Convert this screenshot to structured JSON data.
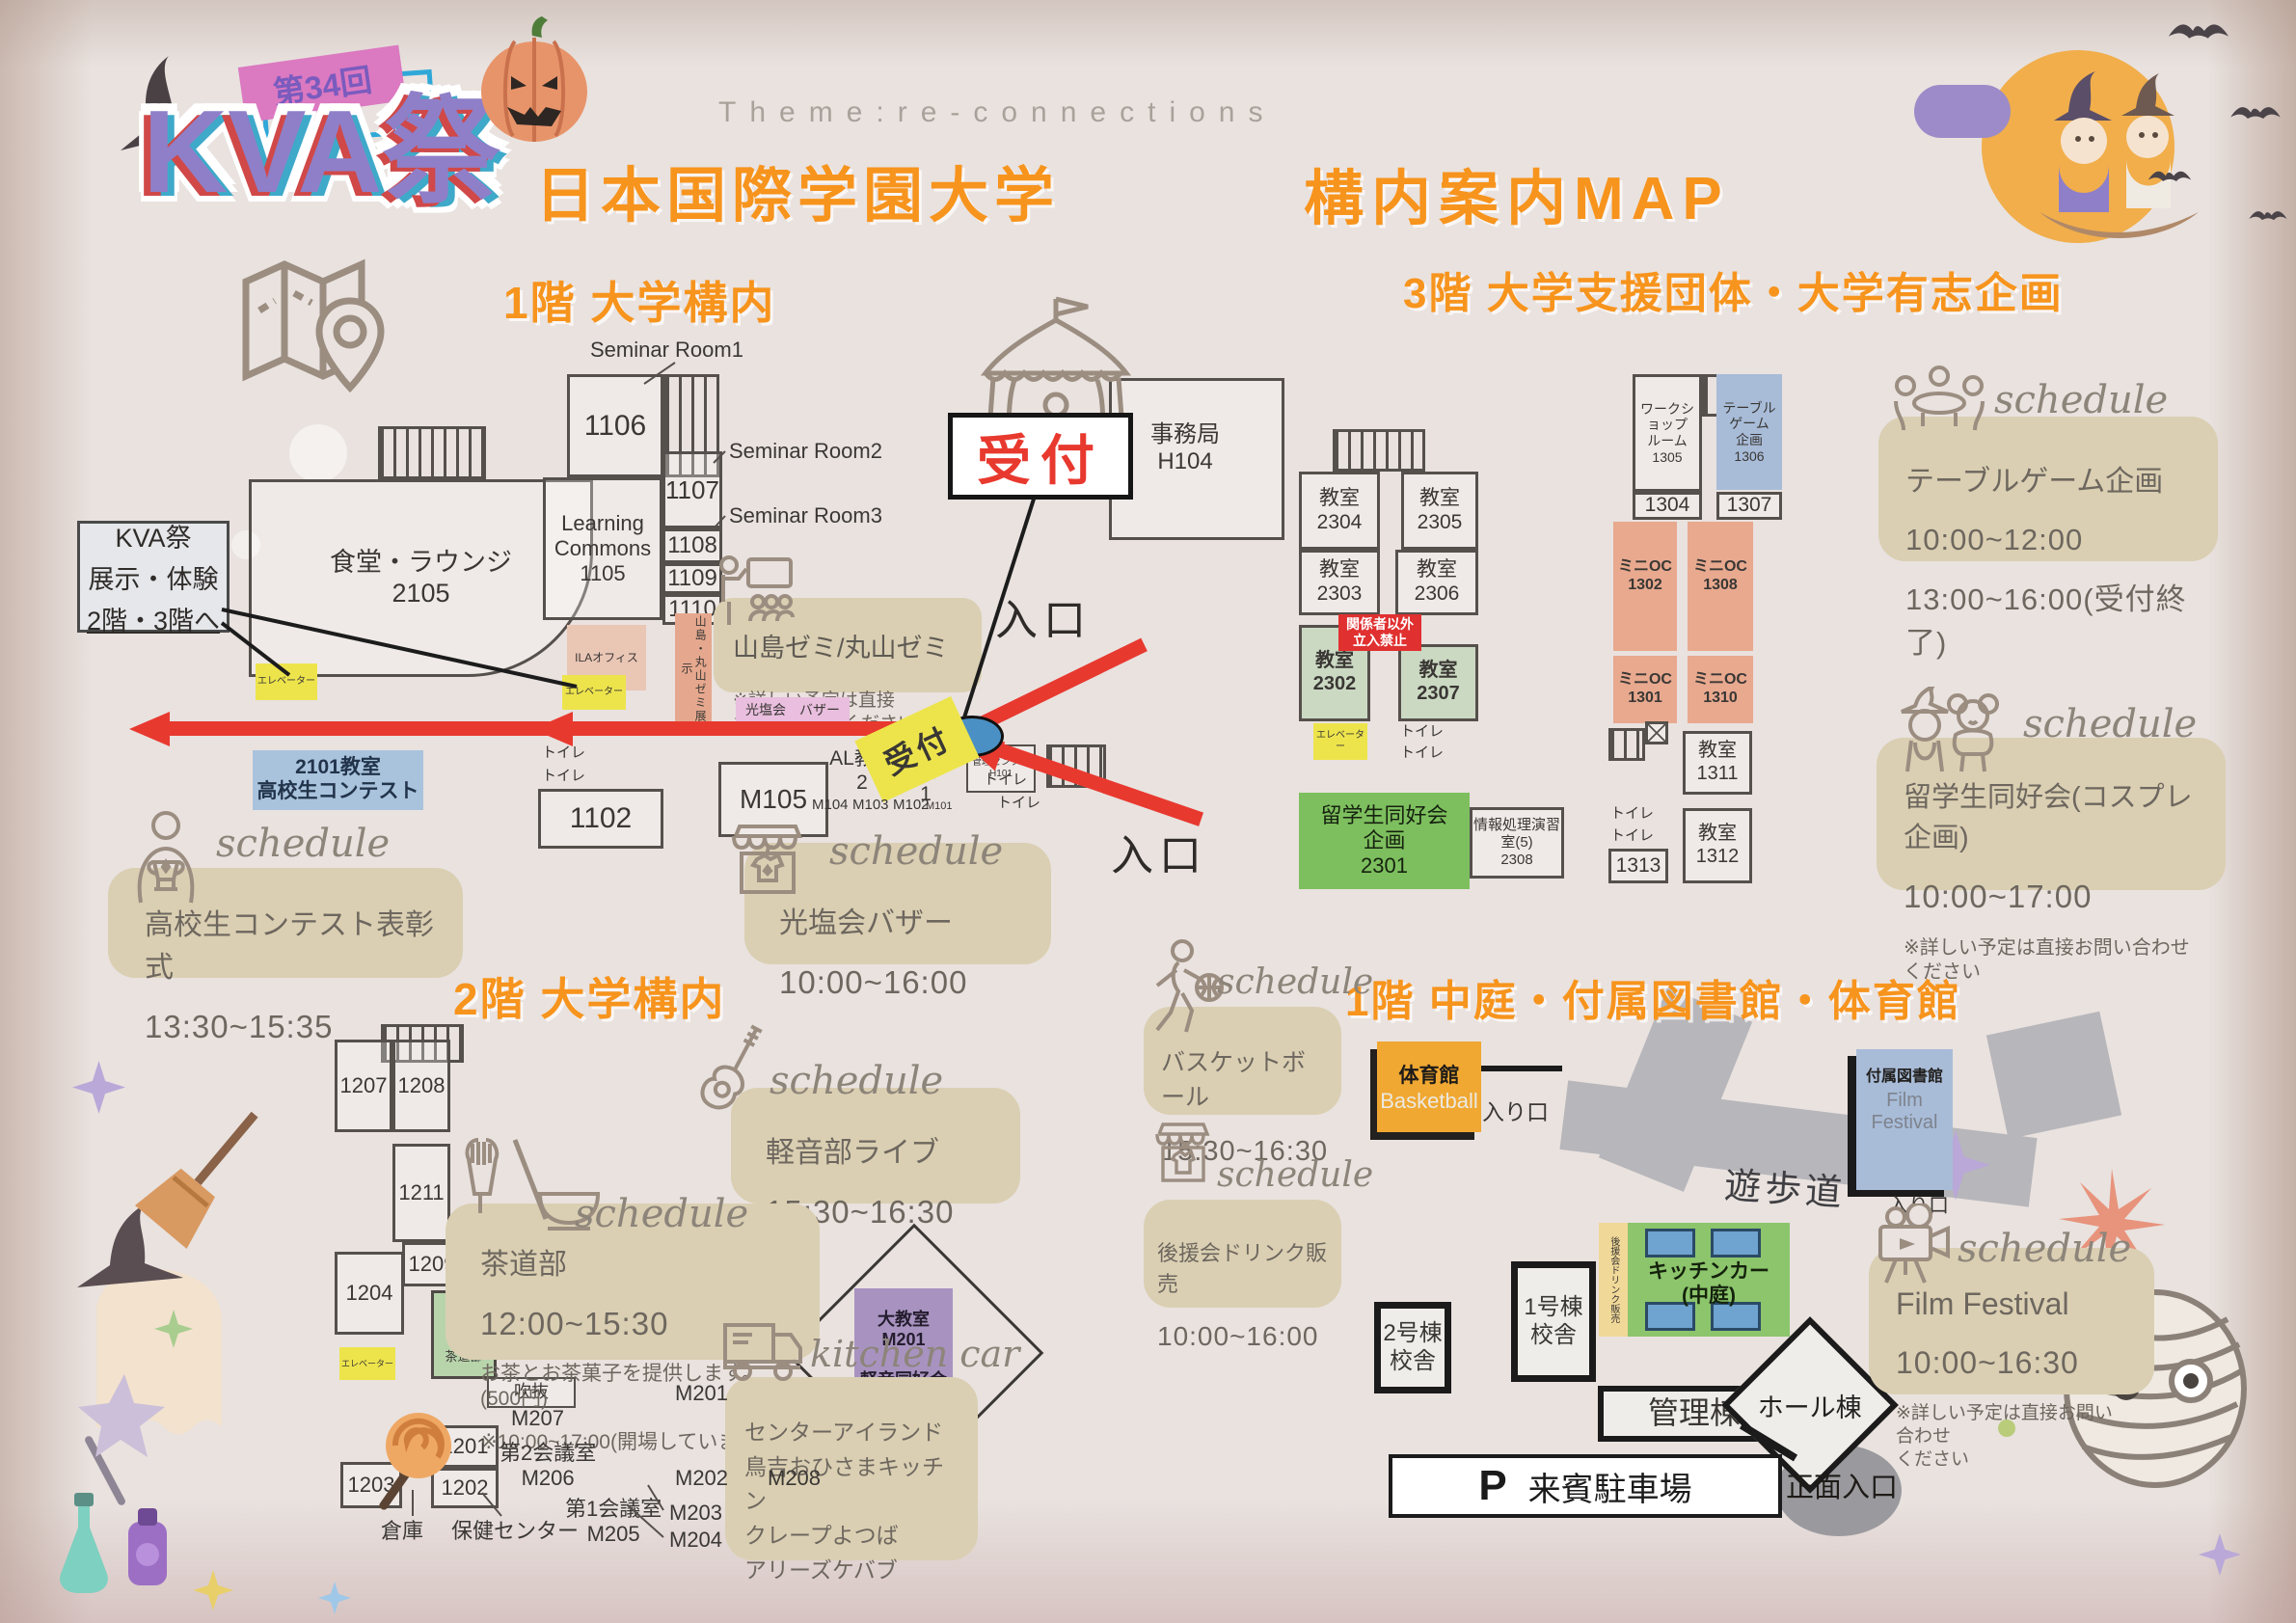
{
  "ui": {
    "schedule_label": "schedule",
    "kitchen_car_label": "kitchen car"
  },
  "header": {
    "edition_badge": "第34回",
    "logo": "KVA祭",
    "theme": "Theme:re-connections",
    "university": "日本国際学園大学",
    "map_title": "構内案内MAP"
  },
  "floor1": {
    "title": "1階 大学構内",
    "reception_sign": "受付",
    "reception_tag": "受付",
    "entrance_top": "入口",
    "entrance_bottom": "入口",
    "callout": {
      "line1": "KVA祭",
      "line2": "展示・体験",
      "line3": "2階・3階へ"
    },
    "labels": {
      "seminar1": "Seminar Room1",
      "seminar2": "Seminar Room2",
      "seminar3": "Seminar Room3"
    },
    "rooms": {
      "cafeteria": "食堂・ラウンジ\n2105",
      "r1106": "1106",
      "learning": "Learning\nCommons\n1105",
      "r1107": "1107",
      "r1108": "1108",
      "r1109": "1109",
      "r1110": "1110",
      "ila": "ILAオフィス",
      "zemi_strip": "山島・丸山ゼミ展示",
      "office": "事務局\nH104",
      "kanri": "管理センター\nH101",
      "contest": "2101教室\n高校生コンテスト",
      "r1102": "1102",
      "m105": "M105",
      "m104": "M104",
      "m103": "M103",
      "m102": "M102",
      "m101": "M101",
      "al2": "AL教室\n2",
      "al1": "AL教室\n1",
      "elevator1": "エレベーター",
      "elevator2": "エレベーター",
      "toilet": "トイレ",
      "bazaar_strip": "光塩会　バザー"
    },
    "note": {
      "title": "山島ゼミ/丸山ゼミ",
      "body": "※詳しい予定は直接\nお問い合わせください"
    },
    "schedules": {
      "contest": {
        "title": "高校生コンテスト表彰式",
        "time": "13:30~15:35"
      },
      "bazaar": {
        "title": "光塩会バザー",
        "time": "10:00~16:00"
      }
    }
  },
  "floor3": {
    "title": "3階 大学支援団体・大学有志企画",
    "rooms": {
      "c2304": "教室\n2304",
      "c2305": "教室\n2305",
      "c2303": "教室\n2303",
      "c2306": "教室\n2306",
      "no_entry": "関係者以外\n立入禁止",
      "c2302": "教室\n2302",
      "c2307": "教室\n2307",
      "elevator": "エレベーター",
      "toilet": "トイレ",
      "ryugaku": "留学生同好会\n企画\n2301",
      "joho": "情報処理演習室(5)\n2308",
      "workshop": "ワークショップ\nルーム\n1305",
      "tablegame": "テーブル\nゲーム\n企画\n1306",
      "r1304": "1304",
      "r1307": "1307",
      "oc1302": "ミニOC\n1302",
      "oc1308": "ミニOC\n1308",
      "oc1301": "ミニOC\n1301",
      "oc1310": "ミニOC\n1310",
      "c1311": "教室\n1311",
      "c1312": "教室\n1312",
      "r1313": "1313"
    },
    "schedules": {
      "tablegame": {
        "title": "テーブルゲーム企画",
        "time1": "10:00~12:00",
        "time2": "13:00~16:00(受付終了)"
      },
      "cosplay": {
        "title": "留学生同好会(コスプレ企画)",
        "time": "10:00~17:00",
        "note": "※詳しい予定は直接お問い合わせ\nください"
      }
    }
  },
  "floor2": {
    "title": "2階 大学構内",
    "rooms": {
      "r1207": "1207",
      "r1208": "1208",
      "r1211": "1211",
      "r1209": "1209",
      "r1204": "1204",
      "sakura": "さくら\nの間\n\n茶道部",
      "elevator": "エレベーター",
      "r1201": "1201",
      "r1202": "1202",
      "r1203": "1203",
      "souko": "倉庫",
      "hoken": "保健センター",
      "m206": "第2会議室\nM206",
      "m207": "M207",
      "m205": "第1会議室\nM205",
      "m201": "M201",
      "m202": "M202",
      "m203": "M203",
      "m204": "M204",
      "m208": "M208",
      "fukinuke1": "吹抜",
      "fukinuke2": "吹抜",
      "daikyoshitsu": "大教室\nM201\n\n軽音同好会"
    },
    "schedules": {
      "band": {
        "title": "軽音部ライブ",
        "time": "15:30~16:30"
      },
      "tea": {
        "title": "茶道部",
        "time": "12:00~15:30",
        "note1": "お茶とお茶菓子を提供します。(500円)",
        "note2": "※10:00~17:00(開場しています)"
      }
    }
  },
  "courtyard": {
    "title": "1階 中庭・付属図書館・体育館",
    "map": {
      "gym": "体育館",
      "gym_en": "Basketball",
      "entrance1": "入り口",
      "promenade": "遊歩道",
      "library": "付属図書館",
      "library_en": "Film\nFestival",
      "entrance2": "入り口",
      "bldg2": "2号棟\n校舎",
      "bldg1": "1号棟\n校舎",
      "drink_strip": "後援会ドリンク販売",
      "kitchen": "キッチンカー\n(中庭)",
      "kanritou": "管理棟",
      "hall": "ホール棟",
      "front": "正面入口",
      "parking_p": "P",
      "parking": "来賓駐車場"
    },
    "schedules": {
      "basketball": {
        "title": "バスケットボール",
        "time": "15:30~16:30"
      },
      "drink": {
        "title": "後援会ドリンク販売",
        "time": "10:00~16:00"
      },
      "kitchen_car": {
        "items": "センターアイランド\n鳥吉おひさまキッチン\nクレープよつば\nアリーズケバブ"
      },
      "film": {
        "title": "Film Festival",
        "time": "10:00~16:30",
        "note": "※詳しい予定は直接お問い合わせ\nください"
      }
    }
  },
  "colors": {
    "accent_orange": "#F7941D",
    "schedule_box": "#DACFB2",
    "arrow_red": "#E8392F",
    "elevator_yellow": "#EDE44C",
    "mini_oc_salmon": "#E8A98F",
    "blue_room": "#A8BCD8",
    "green_room": "#7DBF5E",
    "light_green_room": "#CBD9C3",
    "purple_room": "#A893C0",
    "gym_orange": "#F0A832",
    "bazaar_pink": "#E9BEDE",
    "logo_purple": "#8F7FC8"
  }
}
